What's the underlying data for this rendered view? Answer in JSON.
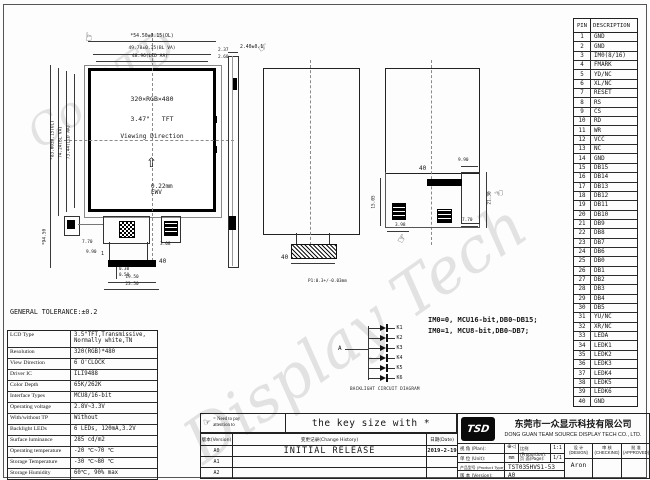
{
  "icons": {
    "hand": "☞",
    "up_arrow": "⇧"
  },
  "watermark": {
    "text_small": "Co.,LTD",
    "text_main": "Display Tech"
  },
  "sheet": {
    "tolerance_note": "GENERAL TOLERANCE:±0.2"
  },
  "pin_table": {
    "col_pin": "PIN",
    "col_desc": "DESCRIPTION",
    "rows": [
      [
        "1",
        "GND"
      ],
      [
        "2",
        "GND"
      ],
      [
        "3",
        "IM0(8/16)"
      ],
      [
        "4",
        "FMARK"
      ],
      [
        "5",
        "YD/NC"
      ],
      [
        "6",
        "XL/NC"
      ],
      [
        "7",
        "RESET"
      ],
      [
        "8",
        "RS"
      ],
      [
        "9",
        "CS"
      ],
      [
        "10",
        "RD"
      ],
      [
        "11",
        "WR"
      ],
      [
        "12",
        "VCC"
      ],
      [
        "13",
        "NC"
      ],
      [
        "14",
        "GND"
      ],
      [
        "15",
        "DB15"
      ],
      [
        "16",
        "DB14"
      ],
      [
        "17",
        "DB13"
      ],
      [
        "18",
        "DB12"
      ],
      [
        "19",
        "DB11"
      ],
      [
        "20",
        "DB10"
      ],
      [
        "21",
        "DB9"
      ],
      [
        "22",
        "DB8"
      ],
      [
        "23",
        "DB7"
      ],
      [
        "24",
        "DB6"
      ],
      [
        "25",
        "DB0"
      ],
      [
        "26",
        "DB1"
      ],
      [
        "27",
        "DB2"
      ],
      [
        "28",
        "DB3"
      ],
      [
        "29",
        "DB4"
      ],
      [
        "30",
        "DB5"
      ],
      [
        "31",
        "YU/NC"
      ],
      [
        "32",
        "XR/NC"
      ],
      [
        "33",
        "LEDA"
      ],
      [
        "34",
        "LEDK1"
      ],
      [
        "35",
        "LEDK2"
      ],
      [
        "36",
        "LEDK3"
      ],
      [
        "37",
        "LEDK4"
      ],
      [
        "38",
        "LEDK5"
      ],
      [
        "39",
        "LEDK6"
      ],
      [
        "40",
        "GND"
      ]
    ]
  },
  "front_view": {
    "dim_width_outline": "*54.50±0.15(OL)",
    "dim_width_bl": "49.78±0.35(BL VA)",
    "dim_width_aa": "48.96(LCD AA)",
    "dim_right_1": "2.37",
    "dim_right_2": "2.60",
    "dim_height_total": "*94.50",
    "dim_height_outline": "*83.00±0.15(OL)",
    "dim_height_bl": "74.24(BL VA)",
    "dim_height_aa": "73.44(LCD AA)",
    "resolution_text": "320×RGB×480",
    "size_text": "3.47\"   TFT",
    "viewing_text": "Viewing Direction",
    "dot_pitch": "0.22mm\nEWV",
    "pin_first": "1",
    "pin_last": "40",
    "dim_fpc_left1": "7.70",
    "dim_fpc_left2": "9.90",
    "dim_pitch1": "0.30",
    "dim_pitch2": "0.50",
    "dim_conn_w": "19.50",
    "dim_fpc_w": "23.50",
    "dim_fpc_right": "3.08"
  },
  "side_view": {
    "dim_thickness": "2.40±0.1"
  },
  "back_view_mid": {
    "pin_label": "40",
    "pitch_note": "P1:0.3+/-0.03mm"
  },
  "back_view_right": {
    "pin_label": "40",
    "dim_top": "9.90",
    "dim_right": "21.30",
    "dim_left": "15.05",
    "dim_bottom_left": "3.98",
    "dim_bottom_right": "7.70"
  },
  "backlight_circuit": {
    "anode_label": "A",
    "cathode_labels": [
      "K1",
      "K2",
      "K3",
      "K4",
      "K5",
      "K6"
    ],
    "caption": "BACKLIGHT CIRCUIT DIAGRAM"
  },
  "interface_note": {
    "line1": "IM0=0, MCU16-bit,DB0~DB15;",
    "line2": "IM0=1, MCU8-bit,DB0~DB7;"
  },
  "spec_table": {
    "rows": [
      {
        "label": "LCD Type",
        "value": "3.5\"TFT,Transmissive,\nNormally white,TN"
      },
      {
        "label": "Resolution",
        "value": "320(RGB)*480"
      },
      {
        "label": "View Direction",
        "value": "6  O'CLOCK"
      },
      {
        "label": "Driver IC",
        "value": "ILI9488"
      },
      {
        "label": "Color Depth",
        "value": "65K/262K"
      },
      {
        "label": "Interface Types",
        "value": "MCU8/16-bit"
      },
      {
        "label": "Operating voltage",
        "value": "2.8V~3.3V"
      },
      {
        "label": "With/without TP",
        "value": "Without"
      },
      {
        "label": "Backlight LEDs",
        "value": "6 LEDs, 120mA,3.2V"
      },
      {
        "label": "Surface luminance",
        "value": "285 cd/m2"
      },
      {
        "label": "Operating temperature",
        "value": "-20 ℃~70 ℃"
      },
      {
        "label": "Storage Temperature",
        "value": "-30 ℃~80 ℃"
      },
      {
        "label": "Storage Humidity",
        "value": "60℃, 90% max"
      }
    ]
  },
  "legend": {
    "hand": "☞",
    "note_line1": "= Need to pay",
    "note_line2": "attention to",
    "key_size_text": "the key size with *"
  },
  "change_history": {
    "headers": [
      "版本(Version)",
      "变更记录(Change History)",
      "日期(Date)"
    ],
    "rows": [
      [
        "A0",
        "INITIAL RELEASE",
        "2019-2-19"
      ],
      [
        "A1",
        "",
        ""
      ],
      [
        "A2",
        "",
        ""
      ]
    ]
  },
  "title_block": {
    "logo_text": "TSD",
    "company_cn": "东莞市一众显示科技有限公司",
    "company_en": "DONG GUAN TEAM SOURCE DISPLAY TECH CO., LTD.",
    "plan_label": "视 角 (Plan):",
    "projection_symbol": "⊕◁",
    "proportion_label": "比例(Proportion):",
    "proportion_value": "1:1",
    "unit_label": "单 位 (Unit):",
    "unit_value": "mm",
    "page_label": "页 面(Page):",
    "page_value": "1/1",
    "product_label": "产品型号 (Product Type):",
    "product_value": "TST035HVS1-53",
    "version_label": "版 本 (Version):",
    "version_value": "A0",
    "design_label_cn": "设 计",
    "design_label_en": "(DESIGN)",
    "design_value": "Aron",
    "checking_label_cn": "审 核",
    "checking_label_en": "(CHECKING)",
    "approved_label_cn": "批 准",
    "approved_label_en": "(APPROVED)"
  }
}
